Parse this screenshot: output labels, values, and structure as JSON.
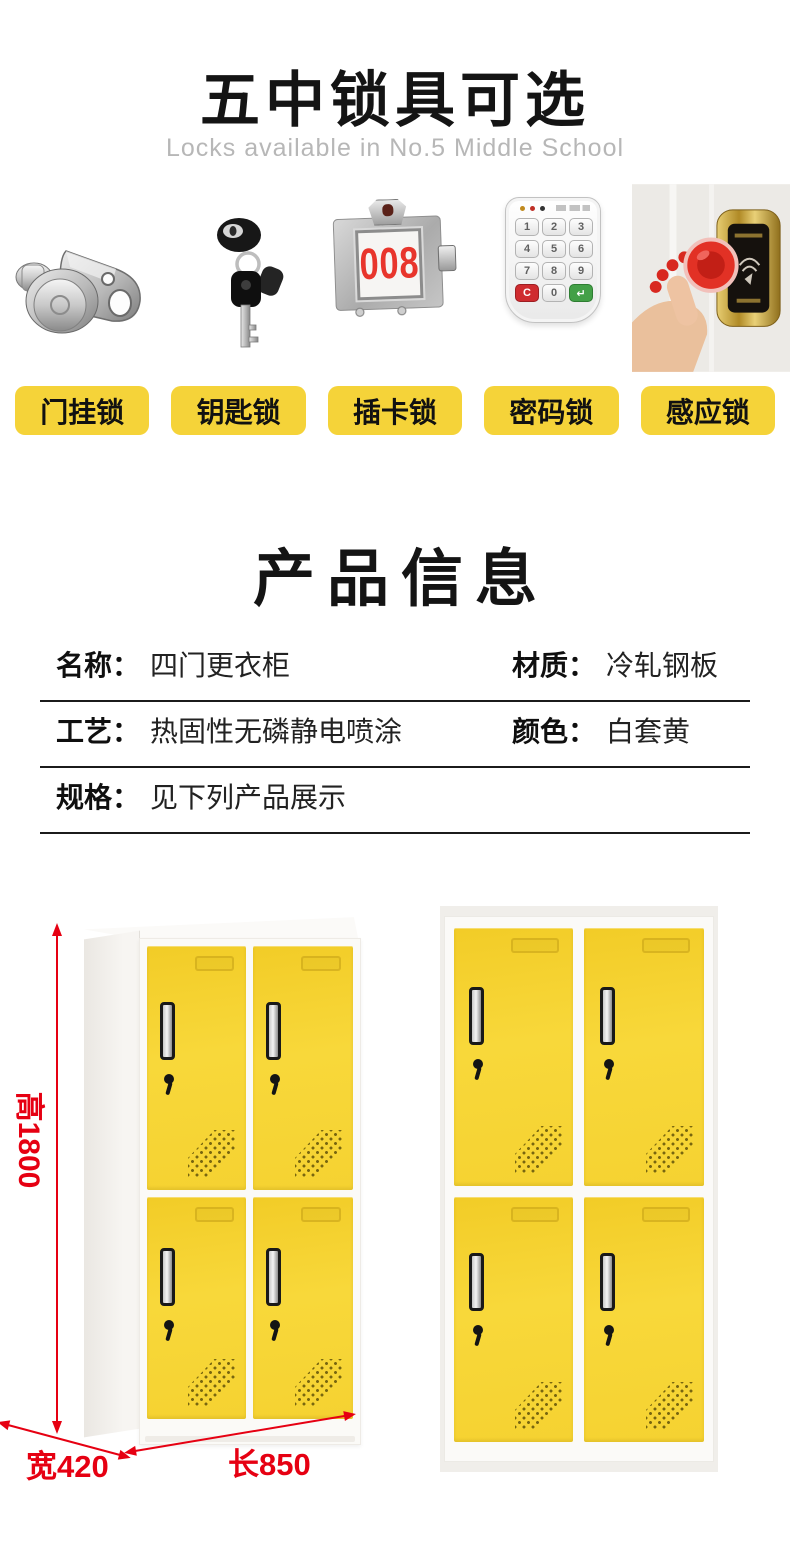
{
  "header": {
    "title": "五中锁具可选",
    "subtitle": "Locks available in No.5 Middle School"
  },
  "locks": {
    "labels": [
      "门挂锁",
      "钥匙锁",
      "插卡锁",
      "密码锁",
      "感应锁"
    ],
    "icons": [
      "hasp-lock-icon",
      "key-lock-icon",
      "card-lock-icon",
      "keypad-lock-icon",
      "rfid-lock-icon"
    ],
    "card_lock_number": "008",
    "keypad_keys": [
      "1",
      "2",
      "3",
      "4",
      "5",
      "6",
      "7",
      "8",
      "9",
      "C",
      "0",
      "↵"
    ]
  },
  "product": {
    "title": "产品信息",
    "rows": [
      {
        "cells": [
          {
            "label": "名称：",
            "value": "四门更衣柜"
          },
          {
            "label": "材质：",
            "value": "冷轧钢板"
          }
        ]
      },
      {
        "cells": [
          {
            "label": "工艺：",
            "value": "热固性无磷静电喷涂"
          },
          {
            "label": "颜色：",
            "value": "白套黄"
          }
        ]
      },
      {
        "cells": [
          {
            "label": "规格：",
            "value": "见下列产品展示"
          }
        ]
      }
    ]
  },
  "lockers": {
    "dim_height": "高1800",
    "dim_width": "宽420",
    "dim_length": "长850"
  },
  "colors": {
    "label_yellow": "#f5d339",
    "door_yellow": "#f6d332",
    "dimension_red": "#e60012",
    "card_number_red": "#e8352c",
    "keypad_c_red": "#cf2b2f",
    "keypad_enter_green": "#43a047",
    "rfid_gold": "#c9a648",
    "fob_red": "#e23125"
  }
}
